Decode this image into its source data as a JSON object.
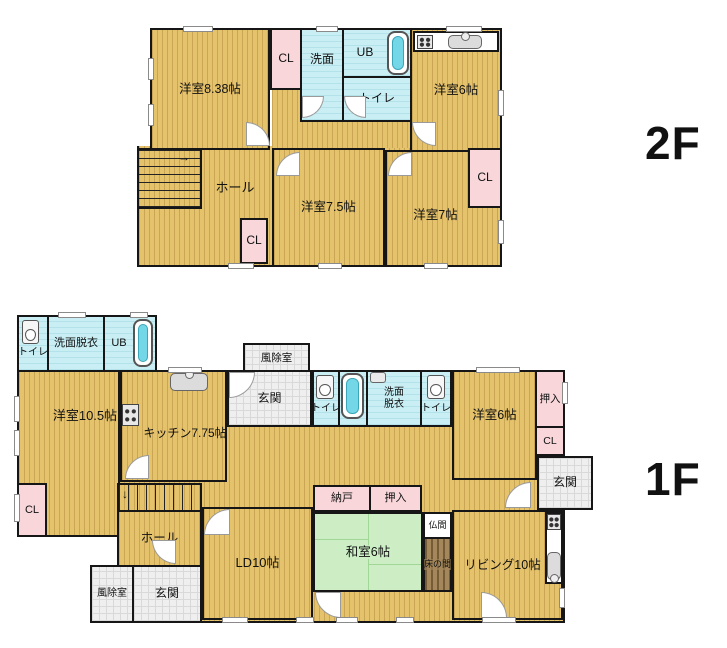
{
  "floor2": {
    "label": "2F",
    "stairs_arrow": "→",
    "rooms": {
      "room838": "洋室8.38帖",
      "cl_top": "CL",
      "senmen": "洗面",
      "ub": "UB",
      "toilet": "トイレ",
      "room6": "洋室6帖",
      "hall": "ホール",
      "room75": "洋室7.5帖",
      "cl_bottom": "CL",
      "room7": "洋室7帖",
      "cl_right": "CL"
    }
  },
  "floor1": {
    "label": "1F",
    "stairs_arrow": "↓",
    "rooms": {
      "toilet_a": "トイレ",
      "senmendatsui_a": "洗面脱衣",
      "ub_a": "UB",
      "room105": "洋室10.5帖",
      "cl_left": "CL",
      "kitchen": "キッチン7.75帖",
      "fujo_top": "風除室",
      "genkan_top": "玄関",
      "toilet_b": "トイレ",
      "ub_b": "UB",
      "senmendatsui_b": "洗面脱衣",
      "toilet_c": "トイレ",
      "room6": "洋室6帖",
      "oshiire_right": "押入",
      "cl_right": "CL",
      "genkan_right": "玄関",
      "hall": "ホール",
      "fujo_bottom": "風除室",
      "genkan_bottom": "玄関",
      "ld": "LD10帖",
      "nando": "納戸",
      "oshiire_center": "押入",
      "washitsu": "和室6帖",
      "butsuma": "仏間",
      "tokonoma": "床の間",
      "living": "リビング10帖"
    }
  },
  "colors": {
    "wall": "#161616",
    "flooring": "#e5c26c",
    "wet_area": "#c9eef4",
    "closet": "#f8d6da",
    "entrance": "#efefef",
    "tatami": "#cdeec5",
    "tokonoma": "#a4875b"
  }
}
